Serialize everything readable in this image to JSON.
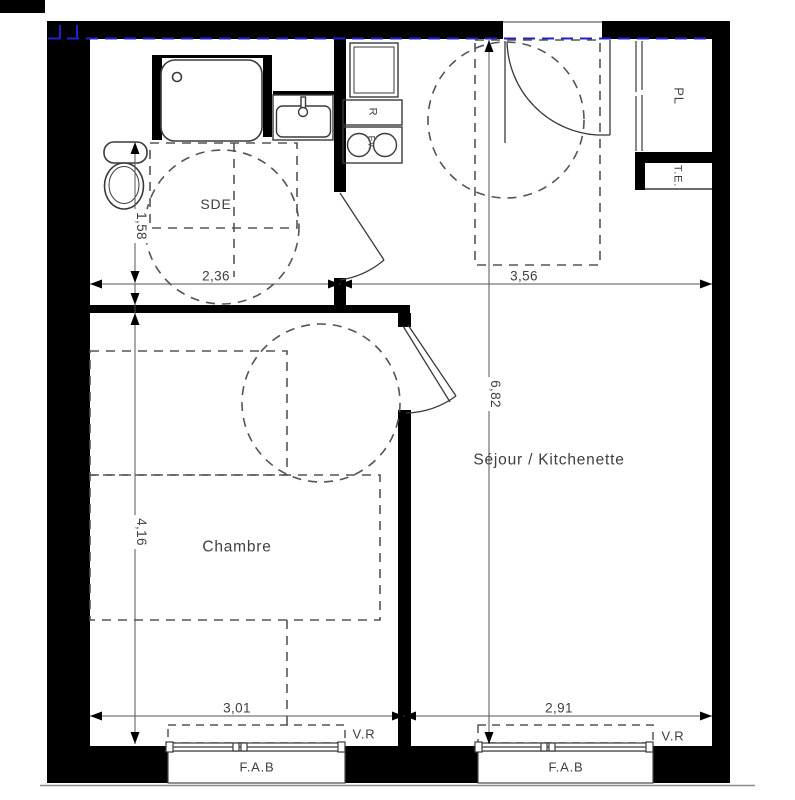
{
  "rooms": {
    "sde": "SDE",
    "chambre": "Chambre",
    "sejour": "Séjour / Kitchenette"
  },
  "fixtures": {
    "closet": "PL",
    "electrical_panel": "T.E.",
    "fridge": "R",
    "sink": "Év."
  },
  "windows": {
    "roller_shutter": "V.R",
    "window_type": "F.A.B"
  },
  "dimensions": {
    "sde_width_m": "2,36",
    "sde_depth_m": "1,58",
    "sejour_top_width_m": "3,56",
    "sejour_length_m": "6,82",
    "chambre_length_m": "4,16",
    "chambre_width_m": "3,01",
    "sejour_bottom_width_m": "2,91"
  },
  "colors": {
    "wall": "#000000",
    "line": "#3a3a3a",
    "dashed": "#555555",
    "dimension": "#555555",
    "annotation_blue": "#2222cc",
    "text": "#3f3f3f",
    "background": "#ffffff"
  }
}
